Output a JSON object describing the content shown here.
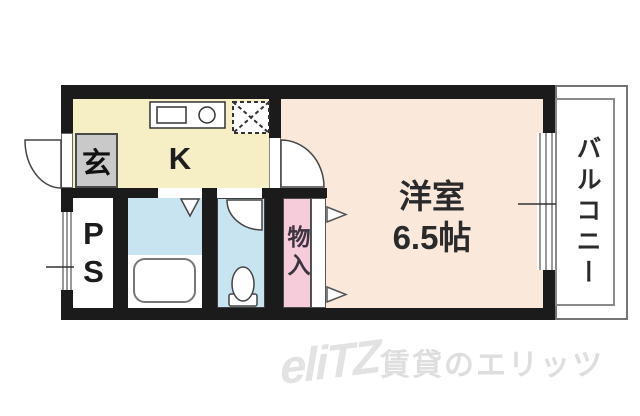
{
  "floorplan": {
    "entrance": {
      "label": "玄"
    },
    "kitchen": {
      "label": "K"
    },
    "western_room": {
      "name": "洋室",
      "size": "6.5帖"
    },
    "closet": {
      "label": "物入"
    },
    "pipe_space": {
      "label": "PS"
    },
    "balcony": {
      "label": "バルコニー"
    },
    "colors": {
      "wall": "#1b1b1b",
      "kitchen_floor": "#f6eec5",
      "room_floor": "#fae8da",
      "closet_fill": "#f6cbda",
      "wet_area_fill": "#c9e4f1",
      "entrance_fill": "#c9c9c9",
      "watermark": "#dedede"
    },
    "icons": {
      "sink-icon": "rectangle",
      "burner-icon": "circle",
      "refrigerator-space-icon": "dashed-x-box",
      "bathtub-icon": "rounded-rect",
      "toilet-icon": "ellipse-on-base",
      "door-swing-icon": "quarter-arc",
      "folding-door-icon": "triangle-down",
      "sliding-door-icon": "triangle-right-pair",
      "window-icon": "multi-line-strip"
    }
  },
  "watermark": {
    "logo": "eliTZ",
    "text": "賃貸のエリッツ"
  }
}
